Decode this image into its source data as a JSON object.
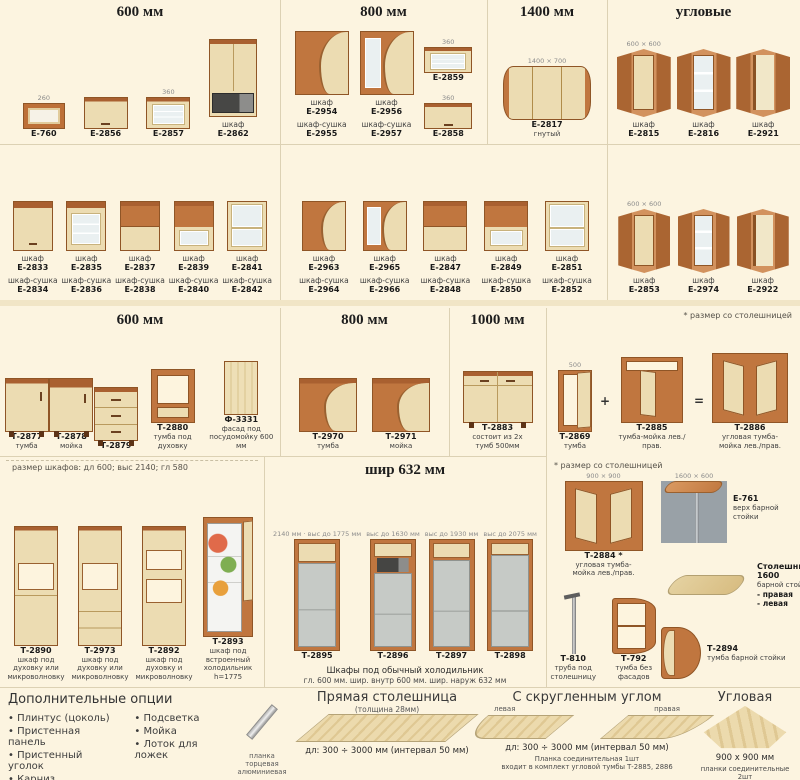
{
  "palette": {
    "background": "#fcf4e0",
    "wood": "#c0763f",
    "front_beige": "#ecdcb2",
    "glass": "#eaf0f1",
    "fridge_gray": "#c6cac6",
    "divider": "#dcd1b4",
    "text": "#3f3f3f"
  },
  "sections": {
    "wall600": {
      "title": "600 мм",
      "items": [
        {
          "code": "Е-760",
          "dim": "260",
          "v": "wall-open",
          "w": 42,
          "h": 26
        },
        {
          "code": "Е-2856",
          "v": "wall-solid",
          "w": 44,
          "h": 32
        },
        {
          "code": "Е-2857",
          "dim": "360",
          "v": "wall-glass",
          "w": 44,
          "h": 32
        },
        {
          "label": "шкаф",
          "code": "Е-2862",
          "v": "microwave",
          "w": 48,
          "h": 78
        }
      ]
    },
    "wall800": {
      "title": "800 мм",
      "items": [
        {
          "label": "шкаф",
          "code": "Е-2954",
          "label2": "шкаф-сушка",
          "code2": "Е-2955",
          "v": "wall-wave",
          "w": 54,
          "h": 64
        },
        {
          "label": "шкаф",
          "code": "Е-2956",
          "label2": "шкаф-сушка",
          "code2": "Е-2957",
          "v": "wall-wave-glass",
          "w": 54,
          "h": 64
        },
        {
          "code": "Е-2859",
          "dim": "360",
          "v": "wall-glass",
          "w": 48,
          "h": 26
        },
        {
          "code": "Е-2858",
          "dim": "360",
          "v": "wall-solid",
          "w": 48,
          "h": 26
        }
      ]
    },
    "wall1400": {
      "title": "1400 мм",
      "items": [
        {
          "code": "Е-2817",
          "sub": "гнутый",
          "dim": "1400 × 700",
          "v": "wall-wide",
          "w": 88,
          "h": 54
        }
      ]
    },
    "wallCorner": {
      "title": "угловые",
      "items": [
        {
          "label": "шкаф",
          "code": "Е-2815",
          "dim": "600 × 600",
          "v": "wall-corner",
          "w": 54,
          "h": 68
        },
        {
          "label": "шкаф",
          "code": "Е-2816",
          "v": "wall-corner-glass",
          "w": 54,
          "h": 68
        },
        {
          "label": "шкаф",
          "code": "Е-2921",
          "v": "wall-corner-open",
          "w": 54,
          "h": 68
        }
      ]
    },
    "row2left": {
      "items": [
        {
          "label": "шкаф",
          "code": "Е-2833",
          "label2": "шкаф-сушка",
          "code2": "Е-2834",
          "v": "wall-solid",
          "w": 40,
          "h": 50
        },
        {
          "label": "шкаф",
          "code": "Е-2835",
          "label2": "шкаф-сушка",
          "code2": "Е-2836",
          "v": "wall-glass",
          "w": 40,
          "h": 50
        },
        {
          "label": "шкаф",
          "code": "Е-2837",
          "label2": "шкаф-сушка",
          "code2": "Е-2838",
          "v": "wall-half",
          "w": 40,
          "h": 50
        },
        {
          "label": "шкаф",
          "code": "Е-2839",
          "label2": "шкаф-сушка",
          "code2": "Е-2840",
          "v": "wall-half-glass",
          "w": 40,
          "h": 50
        },
        {
          "label": "шкаф",
          "code": "Е-2841",
          "label2": "шкаф-сушка",
          "code2": "Е-2842",
          "v": "wall-glass2",
          "w": 40,
          "h": 50
        }
      ]
    },
    "row2mid": {
      "items": [
        {
          "label": "шкаф",
          "code": "Е-2963",
          "label2": "шкаф-сушка",
          "code2": "Е-2964",
          "v": "wall-wave",
          "w": 44,
          "h": 50
        },
        {
          "label": "шкаф",
          "code": "Е-2965",
          "label2": "шкаф-сушка",
          "code2": "Е-2966",
          "v": "wall-wave-glass",
          "w": 44,
          "h": 50
        },
        {
          "label": "шкаф",
          "code": "Е-2847",
          "label2": "шкаф-сушка",
          "code2": "Е-2848",
          "v": "wall-half",
          "w": 44,
          "h": 50
        },
        {
          "label": "шкаф",
          "code": "Е-2849",
          "label2": "шкаф-сушка",
          "code2": "Е-2850",
          "v": "wall-half-glass",
          "w": 44,
          "h": 50
        },
        {
          "label": "шкаф",
          "code": "Е-2851",
          "label2": "шкаф-сушка",
          "code2": "Е-2852",
          "v": "wall-glass2",
          "w": 44,
          "h": 50
        }
      ]
    },
    "row2corner": {
      "items": [
        {
          "label": "шкаф",
          "code": "Е-2853",
          "dim": "600 × 600",
          "v": "wall-corner",
          "w": 52,
          "h": 64
        },
        {
          "label": "шкаф",
          "code": "Е-2974",
          "v": "wall-corner-glass",
          "w": 52,
          "h": 64
        },
        {
          "label": "шкаф",
          "code": "Е-2922",
          "v": "wall-corner-open",
          "w": 52,
          "h": 64
        }
      ]
    },
    "base600": {
      "title": "600 мм",
      "items": [
        {
          "code": "Т-2877",
          "sub": "тумба",
          "v": "base",
          "w": 44,
          "h": 54
        },
        {
          "code": "Т-2878",
          "sub": "мойка",
          "v": "base-sink",
          "w": 44,
          "h": 54
        },
        {
          "code": "Т-2879",
          "v": "base-drawers",
          "w": 44,
          "h": 54
        },
        {
          "code": "Т-2880",
          "sub": "тумба под духовку",
          "v": "base-oven",
          "w": 44,
          "h": 54
        },
        {
          "code": "Ф-3331",
          "sub": "фасад под посудомойку 600 мм",
          "v": "panel",
          "w": 34,
          "h": 54
        }
      ]
    },
    "base800": {
      "title": "800 мм",
      "items": [
        {
          "code": "Т-2970",
          "sub": "тумба",
          "v": "base-wave",
          "w": 58,
          "h": 54
        },
        {
          "code": "Т-2971",
          "sub": "мойка",
          "v": "base-wave",
          "w": 58,
          "h": 54
        }
      ]
    },
    "base1000": {
      "title": "1000 мм",
      "items": [
        {
          "code": "Т-2883",
          "sub": "состоит из 2х тумб 500мм",
          "v": "base-2door",
          "w": 70,
          "h": 52
        }
      ]
    },
    "baseCombo": {
      "note": "* размер со столешницей",
      "plus": "+",
      "equals": "=",
      "items": [
        {
          "code": "Т-2869",
          "sub": "тумба",
          "dim": "500",
          "v": "base-narrow",
          "w": 34,
          "h": 62
        },
        {
          "code": "Т-2885",
          "sub": "тумба-мойка лев./прав.",
          "v": "base-corner",
          "w": 62,
          "h": 66
        },
        {
          "code": "Т-2886",
          "sub": "угловая тумба-мойка лев./прав.",
          "v": "base-corner-big",
          "w": 76,
          "h": 70
        }
      ]
    },
    "tall": {
      "note": "размер шкафов:  дл 600;  выс 2140;  гл 580",
      "items": [
        {
          "code": "Т-2890",
          "sub": "шкаф под духовку или микроволновку",
          "v": "tall-niche",
          "w": 44,
          "h": 120
        },
        {
          "code": "Т-2973",
          "sub": "шкаф под духовку или микроволновку",
          "v": "tall-niche-drawers",
          "w": 44,
          "h": 120
        },
        {
          "code": "Т-2892",
          "sub": "шкаф под духовку и микроволновку",
          "v": "tall-2niche",
          "w": 44,
          "h": 120
        },
        {
          "code": "Т-2893",
          "sub": "шкаф под встроенный холодильник h=1775",
          "v": "tall-fridge-open",
          "w": 50,
          "h": 120
        }
      ]
    },
    "fridge": {
      "title": "шир 632 мм",
      "caption": "Шкафы под обычный холодильник",
      "caption2": "гл. 600 мм.   шир. внутр 600 мм.   шир. наруж 632 мм",
      "items": [
        {
          "code": "Т-2895",
          "dim": "2140 мм · выс до 1775 мм",
          "v": "fridge-cab",
          "w": 46,
          "h": 112
        },
        {
          "code": "Т-2896",
          "dim": "выс до 1630 мм",
          "v": "fridge-cab-mw",
          "w": 46,
          "h": 112
        },
        {
          "code": "Т-2897",
          "dim": "выс до 1930 мм",
          "v": "fridge-cab-2",
          "w": 46,
          "h": 112
        },
        {
          "code": "Т-2898",
          "dim": "выс до 2075 мм",
          "v": "fridge-cab-3",
          "w": 46,
          "h": 112
        }
      ]
    }
  },
  "bar": {
    "note": "* размер со столешницей",
    "corner": {
      "code": "Т-2884 *",
      "sub": "угловая тумба-мойка лев./прав.",
      "dim": "900 × 900",
      "v": "base-corner-big",
      "w": 78,
      "h": 70
    },
    "leg": {
      "code": "Т-810",
      "sub": "труба под столешницу",
      "v": "leg",
      "w": 26,
      "h": 62
    },
    "shelf": {
      "code": "Т-792",
      "sub": "тумба без фасадов",
      "v": "open-shelf",
      "w": 44,
      "h": 56
    },
    "top": {
      "code": "Е-761",
      "sub": "верх барной стойки",
      "dim": "1600 × 600",
      "v": "bar-assembly",
      "w": 66,
      "h": 62,
      "side": true
    },
    "slab": {
      "code": "Столешница 1600",
      "sub": "барной стойки",
      "opts": [
        "- правая",
        "- левая"
      ],
      "v": "slab-top",
      "w": 70,
      "h": 20,
      "side": true
    },
    "stand": {
      "code": "Т-2894",
      "sub": "тумба барной стойки",
      "v": "bar-stand",
      "w": 40,
      "h": 52,
      "side": true
    }
  },
  "bottom": {
    "options": {
      "title": "Дополнительные опции",
      "col1": [
        "Плинтус (цоколь)",
        "Пристенная панель",
        "Пристенный уголок",
        "Карниз"
      ],
      "col2": [
        "Подсветка",
        "Мойка",
        "Лоток для ложек"
      ]
    },
    "edge": {
      "caption": "планка торцевая\nалюминиевая",
      "gfx": {
        "v": "strip",
        "w": 8,
        "h": 40
      }
    },
    "straight": {
      "title": "Прямая столешница",
      "subtitle": "(толщина 28мм)",
      "gfx": {
        "v": "slab",
        "w": 150,
        "h": 28
      },
      "size": "дл: 300 ÷ 3000 мм (интервал 50 мм)"
    },
    "rounded": {
      "title": "С скругленным углом",
      "tag_left": "левая",
      "tag_right": "правая",
      "gfx_left": {
        "v": "slab-l",
        "w": 86,
        "h": 24
      },
      "gfx_right": {
        "v": "slab-r",
        "w": 86,
        "h": 24
      },
      "size": "дл: 300 ÷ 3000 мм (интервал 50 мм)",
      "note": "Планка соединительная 1шт\nвходит в комплект угловой тумбы Т-2885, 2886"
    },
    "corner": {
      "title": "Угловая",
      "gfx": {
        "v": "slab-corner",
        "w": 86,
        "h": 44
      },
      "size": "900 x 900 мм",
      "note": "планки соединительные 2шт\nвходят в комплект тумбы Т-2884"
    }
  }
}
